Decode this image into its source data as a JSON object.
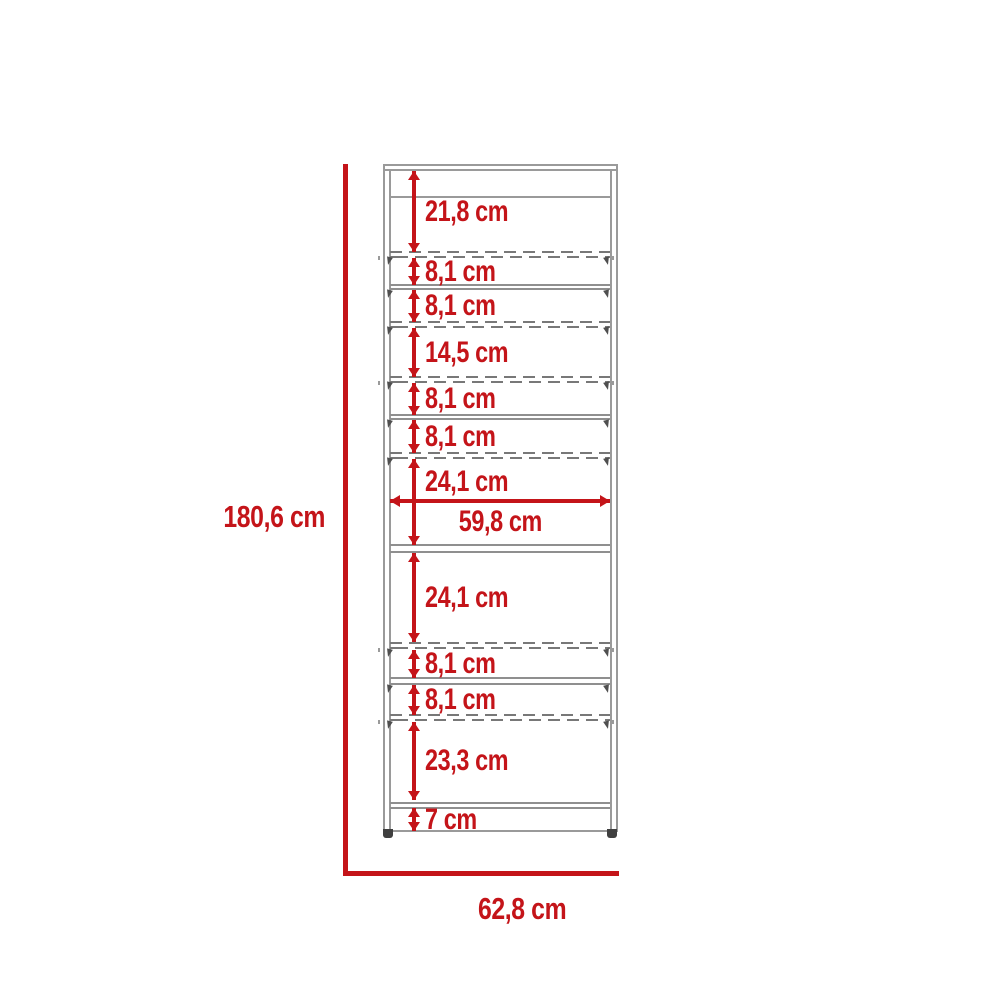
{
  "diagram": {
    "kind": "furniture-dimension-drawing",
    "unit": "cm",
    "overall_height": {
      "label": "180,6 cm",
      "value": 180.6
    },
    "overall_width": {
      "label": "62,8 cm",
      "value": 62.8
    },
    "inner_width": {
      "label": "59,8 cm",
      "value": 59.8
    },
    "vertical_sections_top_to_bottom": [
      {
        "label": "21,8 cm",
        "value": 21.8
      },
      {
        "label": "8,1 cm",
        "value": 8.1
      },
      {
        "label": "8,1 cm",
        "value": 8.1
      },
      {
        "label": "14,5 cm",
        "value": 14.5
      },
      {
        "label": "8,1 cm",
        "value": 8.1
      },
      {
        "label": "8,1 cm",
        "value": 8.1
      },
      {
        "label": "24,1 cm",
        "value": 24.1
      },
      {
        "label": "24,1 cm",
        "value": 24.1
      },
      {
        "label": "8,1 cm",
        "value": 8.1
      },
      {
        "label": "8,1 cm",
        "value": 8.1
      },
      {
        "label": "23,3 cm",
        "value": 23.3
      },
      {
        "label": "7 cm",
        "value": 7
      }
    ],
    "colors": {
      "dimension_red": "#c41419",
      "cabinet_line_gray": "#9a9a9a",
      "dashed_line_gray": "#787878"
    }
  }
}
